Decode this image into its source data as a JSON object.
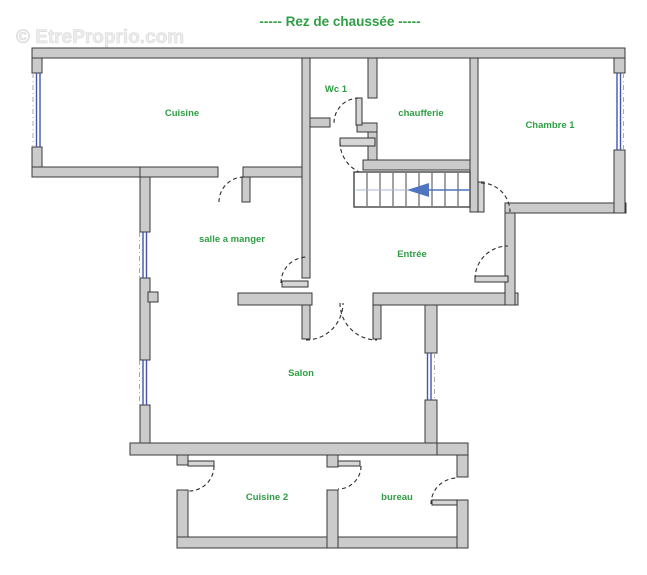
{
  "title": "----- Rez de chaussée -----",
  "watermark": "© EtreProprio.com",
  "rooms": {
    "cuisine": {
      "label": "Cuisine"
    },
    "wc1": {
      "label": "Wc 1"
    },
    "chaufferie": {
      "label": "chaufferie"
    },
    "chambre1": {
      "label": "Chambre 1"
    },
    "salle_a_manger": {
      "label": "salle a manger"
    },
    "entree": {
      "label": "Entrée"
    },
    "salon": {
      "label": "Salon"
    },
    "cuisine2": {
      "label": "Cuisine 2"
    },
    "bureau": {
      "label": "bureau"
    }
  },
  "stairs": {
    "arrow_direction": "left"
  },
  "colors": {
    "room_label": "#2f9e44",
    "title": "#2f9e44",
    "wall_fill": "#cbcbcb",
    "wall_stroke": "#3a3a3a",
    "window_blue": "#4355ad",
    "stair_arrow_blue": "#4f74c0",
    "watermark_gray": "#ececec"
  }
}
